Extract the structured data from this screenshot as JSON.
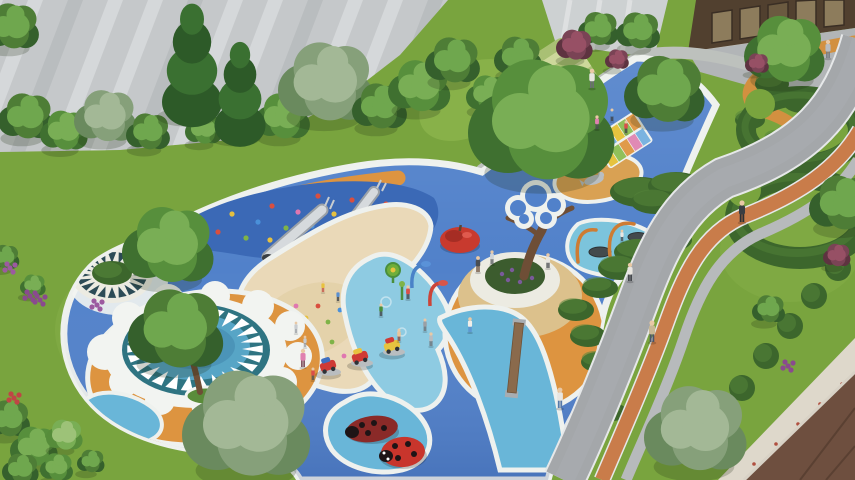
{
  "meta": {
    "title": "Aerial architectural rendering of a residential children's playground",
    "render_type": "3d-landscape-visualization"
  },
  "palette": {
    "lawn": "#79a43e",
    "lawn_light": "#8db54e",
    "road": "#a4a7aa",
    "road_tone": "#b0b3b6",
    "jog_strip": "#c97c4a",
    "sidewalk": "#b7babc",
    "plaza": "#b2b5b7",
    "facade": "#c5c8ca",
    "facade_stripe": "#e6e8e9",
    "facade_dark": "#adb1b4",
    "wall": "#cdd1d2",
    "entrance": "#51402f",
    "glass": "#8d7c5c",
    "roof": "#6e4f3f",
    "roof_line": "#5a4032",
    "pavers": "#ded8cb",
    "play_blue": "#5181ca",
    "mound_blue": "#3b69b6",
    "splash_blue": "#8ecbe2",
    "path_cyan": "#69b6d8",
    "pool_blue": "#7cc4dc",
    "border_white": "#eef1ee",
    "sand": "#ead9b8",
    "sand_dark": "#e0cda0",
    "sand_mound": "#d9a153",
    "orange": "#dd9440",
    "path_orange": "#d29040",
    "tan_ring": "#dcc18c",
    "teal": "#2f7482",
    "teal_dark": "#2c4b56",
    "mandala_blue": "#57a5c6",
    "hedge": "#3c662c",
    "hedge_light": "#55853a",
    "bench": "#ecebe2",
    "planter_green": "#3c5c2e",
    "trunk": "#6e4e36",
    "terrace_a": "#a9c074",
    "terrace_b": "#cdd89b",
    "walkway": "#bdc1bd",
    "skin": "#e9c9a6",
    "tree": {
      "dark": [
        "#35602c",
        "#4e7d36",
        "#6fa74e"
      ],
      "mid": [
        "#3f7030",
        "#578f3c",
        "#79ae55"
      ],
      "gray": [
        "#6a8a5e",
        "#86a07a",
        "#a3b896"
      ],
      "light": [
        "#568c3a",
        "#79ae55",
        "#9dc278"
      ],
      "maroon": [
        "#5e3340",
        "#7a4355",
        "#975065"
      ],
      "conifer": [
        "#2d5a28",
        "#3a7031"
      ]
    }
  },
  "hold_colors": [
    "#d94f3f",
    "#e5c040",
    "#7fb347",
    "#4a90d9",
    "#e077b0"
  ],
  "rainbow": [
    "#e08ab4",
    "#7ab3e0",
    "#e6c33f",
    "#90c05a",
    "#e09a4a"
  ],
  "climbing_holds": [
    [
      218,
      232,
      0
    ],
    [
      232,
      214,
      1
    ],
    [
      246,
      238,
      2
    ],
    [
      258,
      222,
      3
    ],
    [
      270,
      240,
      1
    ],
    [
      272,
      206,
      0
    ],
    [
      286,
      228,
      2
    ],
    [
      298,
      212,
      4
    ],
    [
      300,
      242,
      1
    ],
    [
      312,
      226,
      3
    ],
    [
      318,
      196,
      0
    ],
    [
      328,
      238,
      2
    ],
    [
      334,
      214,
      1
    ],
    [
      346,
      228,
      4
    ],
    [
      352,
      200,
      0
    ],
    [
      360,
      240,
      3
    ],
    [
      366,
      214,
      2
    ],
    [
      378,
      226,
      1
    ],
    [
      386,
      204,
      0
    ],
    [
      392,
      236,
      4
    ],
    [
      402,
      218,
      2
    ],
    [
      412,
      230,
      3
    ]
  ],
  "sand_toys": [
    [
      296,
      306,
      4
    ],
    [
      306,
      318,
      1
    ],
    [
      318,
      306,
      0
    ],
    [
      328,
      322,
      2
    ],
    [
      340,
      310,
      3
    ],
    [
      350,
      324,
      1
    ],
    [
      312,
      338,
      0
    ],
    [
      332,
      342,
      2
    ],
    [
      298,
      352,
      3
    ],
    [
      318,
      358,
      0
    ],
    [
      330,
      364,
      1
    ],
    [
      344,
      356,
      4
    ],
    [
      352,
      340,
      2
    ],
    [
      285,
      332,
      1
    ]
  ],
  "people": [
    [
      592,
      88,
      0.85,
      "#e8e6e2",
      "#6b6f73"
    ],
    [
      597,
      129,
      0.6,
      "#e080b0",
      "#4a4e52"
    ],
    [
      612,
      121,
      0.55,
      "#5a8fd0",
      "#3c4044"
    ],
    [
      626,
      133,
      0.55,
      "#d8504a",
      "#3c4044"
    ],
    [
      742,
      222,
      0.95,
      "#3a3e42",
      "#2c3034"
    ],
    [
      828,
      58,
      0.8,
      "#b8bcc0",
      "#787c80"
    ],
    [
      652,
      342,
      0.95,
      "#c9b896",
      "#4a5568"
    ],
    [
      478,
      272,
      0.7,
      "#4a4e52",
      "#6b4f3a"
    ],
    [
      492,
      264,
      0.6,
      "#d0d4d8",
      "#5a5e62"
    ],
    [
      548,
      268,
      0.65,
      "#e8e6e0",
      "#4a4e52"
    ],
    [
      630,
      281,
      0.8,
      "#e8e6e0",
      "#3c4044"
    ],
    [
      470,
      332,
      0.65,
      "#f0eee8",
      "#5a8fd0"
    ],
    [
      560,
      408,
      0.9,
      "#e8e6e2",
      "#5578a8"
    ],
    [
      408,
      299,
      0.6,
      "#d8504a",
      "#3c4044"
    ],
    [
      381,
      316,
      0.55,
      "#4a8f3c",
      "#3c4044"
    ],
    [
      399,
      341,
      0.55,
      "#e8c49a",
      "#8a4a3c"
    ],
    [
      431,
      346,
      0.6,
      "#b8bcc0",
      "#6b6f73"
    ],
    [
      303,
      367,
      0.8,
      "#e080b0",
      "#7a4a5a"
    ],
    [
      313,
      380,
      0.55,
      "#d8504a",
      "#4a4e52"
    ],
    [
      323,
      292,
      0.5,
      "#e8c23f",
      "#c4554a"
    ],
    [
      338,
      301,
      0.5,
      "#5a8fd0",
      "#3c4044"
    ],
    [
      425,
      331,
      0.55,
      "#9aa0a5",
      "#6b6f73"
    ],
    [
      622,
      241,
      0.5,
      "#e8e6e2",
      "#4a4e52"
    ],
    [
      296,
      333,
      0.5,
      "#c8ccd0",
      "#9aa0a5"
    ],
    [
      305,
      347,
      0.5,
      "#c8ccd0",
      "#9aa0a5"
    ]
  ],
  "trees": [
    [
      14,
      28,
      30,
      "dark"
    ],
    [
      28,
      118,
      30,
      "dark"
    ],
    [
      66,
      132,
      26,
      "mid"
    ],
    [
      108,
      118,
      34,
      "gray"
    ],
    [
      150,
      133,
      24,
      "dark"
    ],
    [
      205,
      130,
      20,
      "mid"
    ],
    [
      285,
      118,
      30,
      "mid"
    ],
    [
      330,
      85,
      52,
      "gray"
    ],
    [
      382,
      108,
      30,
      "dark"
    ],
    [
      422,
      88,
      34,
      "mid"
    ],
    [
      455,
      62,
      30,
      "dark"
    ],
    [
      490,
      95,
      24,
      "mid"
    ],
    [
      520,
      58,
      26,
      "dark"
    ],
    [
      600,
      30,
      22,
      "dark"
    ],
    [
      640,
      32,
      24,
      "dark"
    ],
    [
      576,
      46,
      20,
      "maroon"
    ],
    [
      618,
      60,
      13,
      "maroon"
    ],
    [
      668,
      92,
      44,
      "dark"
    ],
    [
      548,
      125,
      80,
      "mid"
    ],
    [
      172,
      248,
      50,
      "mid"
    ],
    [
      180,
      332,
      52,
      "dark"
    ],
    [
      252,
      428,
      70,
      "gray"
    ],
    [
      700,
      432,
      56,
      "gray"
    ],
    [
      788,
      52,
      44,
      "mid"
    ],
    [
      758,
      64,
      13,
      "maroon"
    ],
    [
      845,
      205,
      36,
      "dark"
    ],
    [
      838,
      256,
      15,
      "maroon"
    ],
    [
      10,
      420,
      24,
      "dark"
    ],
    [
      36,
      448,
      26,
      "mid"
    ],
    [
      66,
      436,
      20,
      "light"
    ],
    [
      22,
      470,
      20,
      "dark"
    ],
    [
      58,
      468,
      18,
      "mid"
    ],
    [
      92,
      462,
      15,
      "dark"
    ],
    [
      6,
      258,
      16,
      "dark"
    ],
    [
      34,
      286,
      14,
      "mid"
    ],
    [
      770,
      310,
      18,
      "dark"
    ]
  ],
  "conifers": [
    [
      192,
      72,
      1
    ],
    [
      240,
      100,
      0.85
    ]
  ],
  "hedges": [
    [
      640,
      192,
      30,
      15
    ],
    [
      676,
      186,
      28,
      14
    ],
    [
      702,
      196,
      20,
      11
    ],
    [
      655,
      202,
      24,
      12
    ],
    [
      640,
      252,
      26,
      13
    ],
    [
      668,
      240,
      24,
      12
    ],
    [
      620,
      268,
      22,
      12
    ],
    [
      600,
      288,
      18,
      10
    ],
    [
      576,
      310,
      18,
      11
    ],
    [
      588,
      336,
      18,
      11
    ],
    [
      598,
      362,
      17,
      10
    ],
    [
      606,
      388,
      16,
      10
    ],
    [
      612,
      412,
      15,
      9
    ],
    [
      772,
      84,
      17,
      10
    ],
    [
      802,
      102,
      19,
      11
    ],
    [
      750,
      120,
      15,
      9
    ],
    [
      818,
      130,
      20,
      12
    ],
    [
      780,
      140,
      16,
      9
    ]
  ],
  "hedgerow": [
    [
      838,
      268
    ],
    [
      814,
      296
    ],
    [
      790,
      326
    ],
    [
      766,
      356
    ],
    [
      742,
      388
    ],
    [
      720,
      420
    ],
    [
      700,
      452
    ]
  ],
  "paver_dots": [
    [
      842,
      384
    ],
    [
      820,
      404
    ],
    [
      798,
      424
    ],
    [
      776,
      444
    ],
    [
      754,
      464
    ]
  ],
  "flowers": [
    [
      10,
      268,
      "#9c5aa0"
    ],
    [
      30,
      296,
      "#8a4a8e"
    ],
    [
      97,
      305,
      "#9c5aa0"
    ],
    [
      14,
      398,
      "#c04545"
    ],
    [
      40,
      300,
      "#8a4a8e"
    ],
    [
      788,
      366,
      "#8a4a8e"
    ]
  ],
  "riders": [
    {
      "x": 330,
      "y": 372,
      "body": "#cf3a35",
      "top": "#3f6fc0"
    },
    {
      "x": 362,
      "y": 363,
      "body": "#cf3a35",
      "top": "#e8c23f"
    },
    {
      "x": 394,
      "y": 352,
      "body": "#e6c33f",
      "top": "#cf3a35"
    }
  ],
  "mandala": {
    "main": {
      "n": 26,
      "cx": 195,
      "cy": 349,
      "a1": 68,
      "b1": 42,
      "a2": 47,
      "b2": 27,
      "w": 0.09,
      "color": "#ffffff"
    },
    "small": {
      "n": 20,
      "cx": 112,
      "cy": 275,
      "a1": 35,
      "b1": 23,
      "a2": 21,
      "b2": 12,
      "w": 0.12,
      "color": "#2c4b56"
    }
  }
}
